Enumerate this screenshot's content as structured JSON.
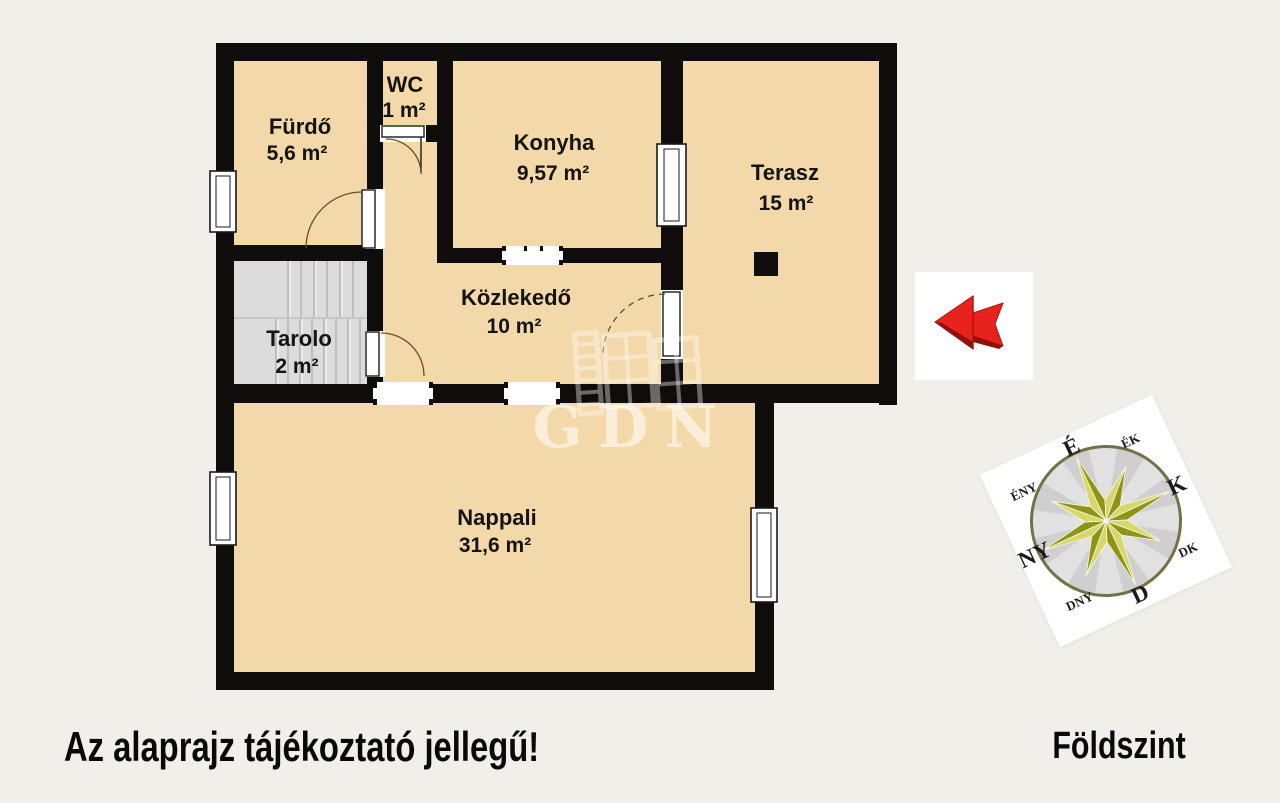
{
  "rooms": {
    "furdo": {
      "name": "Fürdő",
      "area": "5,6 m²"
    },
    "wc": {
      "name": "WC",
      "area": "1 m²"
    },
    "konyha": {
      "name": "Konyha",
      "area": "9,57 m²"
    },
    "terasz": {
      "name": "Terasz",
      "area": "15 m²"
    },
    "kozlekedo": {
      "name": "Közlekedő",
      "area": "10 m²"
    },
    "tarolo": {
      "name": "Tarolo",
      "area": "2 m²"
    },
    "nappali": {
      "name": "Nappali",
      "area": "31,6 m²"
    }
  },
  "footer": {
    "disclaimer": "Az alaprajz tájékoztató jellegű!",
    "floor": "Földszint"
  },
  "watermark": {
    "text": "GDN"
  },
  "compass": {
    "n": "É",
    "ne": "ÉK",
    "e": "K",
    "se": "DK",
    "s": "D",
    "sw": "DNY",
    "w": "NY",
    "nw": "ÉNY"
  },
  "colors": {
    "background": "#f0efea",
    "room_fill": "#f3d9a9",
    "wall": "#0e0d0b",
    "stairs": "#dcdcdc",
    "arrow_red": "#e8231d",
    "compass_star_dark": "#8f9414",
    "compass_star_light": "#d6d86c"
  }
}
